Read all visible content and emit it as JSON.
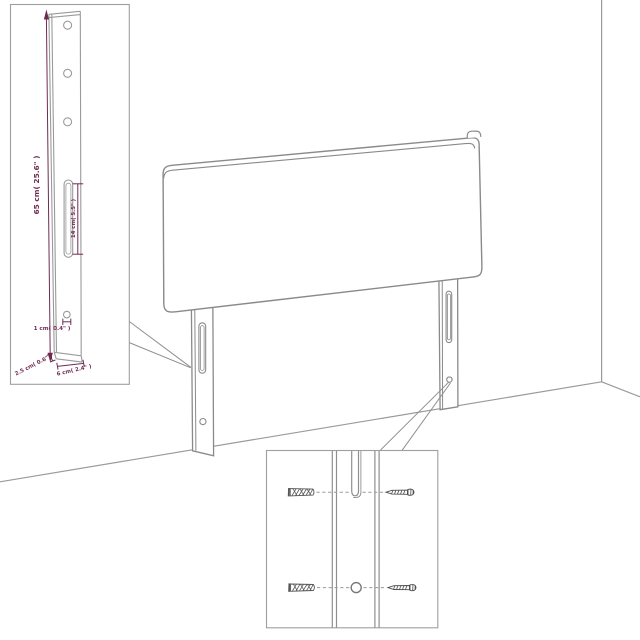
{
  "figure": {
    "subject": "Headboard with wall-mount legs — assembly and measurement diagram",
    "background_color": "#ffffff",
    "line_color": "#8f8f8f",
    "dimension_color": "#702b52"
  },
  "leg_detail_inset": {
    "height_label": "65 cm( 25.6\" )",
    "slot_label": "14 cm( 5.5\" )",
    "hole_label": "1 cm( 0.4\" )",
    "depth_label": "2.5 cm( 0.6\" )",
    "width_label": "6 cm( 2.4\" )",
    "hole_count": 3
  },
  "hardware_inset": {
    "rows": 2,
    "items_per_row": [
      "wall-anchor",
      "screw"
    ]
  }
}
